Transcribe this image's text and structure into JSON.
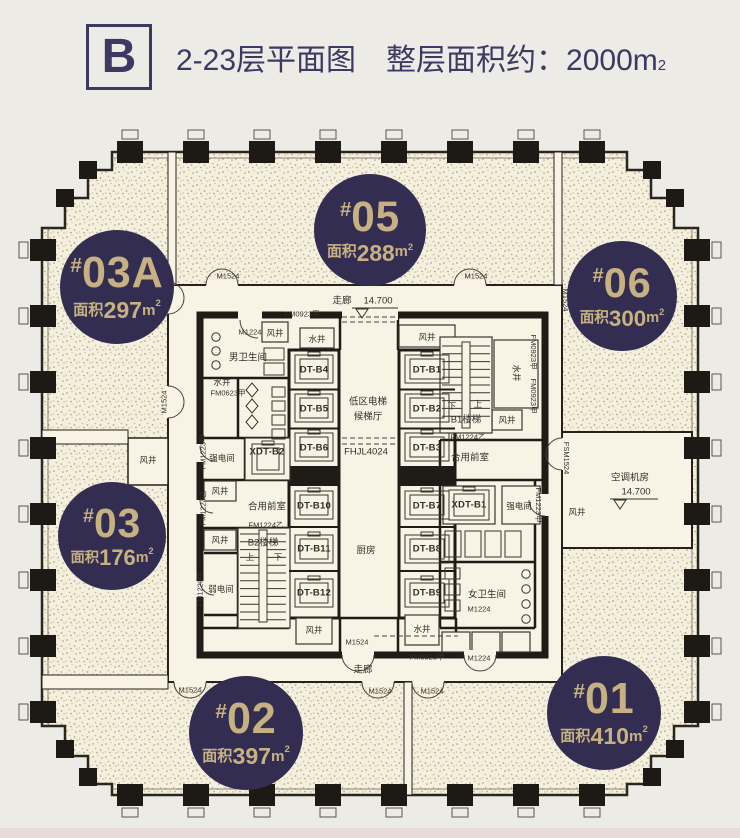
{
  "title": {
    "block_letter": "B",
    "heading_left": "2-23层平面图",
    "area_note": "整层面积约：2000m",
    "area_sup": "2"
  },
  "badge_common": {
    "hash": "#",
    "area_prefix": "面积",
    "unit": "m",
    "sup": "2"
  },
  "badges": [
    {
      "number": "03A",
      "area": "297",
      "cx": 117,
      "cy": 287,
      "r": 57
    },
    {
      "number": "05",
      "area": "288",
      "cx": 370,
      "cy": 230,
      "r": 56
    },
    {
      "number": "06",
      "area": "300",
      "cx": 622,
      "cy": 296,
      "r": 55
    },
    {
      "number": "03",
      "area": "176",
      "cx": 112,
      "cy": 536,
      "r": 54
    },
    {
      "number": "02",
      "area": "397",
      "cx": 246,
      "cy": 733,
      "r": 57
    },
    {
      "number": "01",
      "area": "410",
      "cx": 604,
      "cy": 713,
      "r": 57
    }
  ],
  "colors": {
    "navy": "#3d3963",
    "badge_navy": "#332e51",
    "badge_gold": "#c7b183",
    "wall": "#1f1b16",
    "floor_cream": "#f5efdd",
    "background": "#ecebe6"
  },
  "plan_labels": [
    {
      "t": "走廊",
      "x": 342,
      "y": 301,
      "c": "rm"
    },
    {
      "t": "14.700",
      "x": 378,
      "y": 301,
      "c": "rm"
    },
    {
      "t": "FM0923甲",
      "x": 302,
      "y": 314,
      "c": "code"
    },
    {
      "t": "M1524",
      "x": 228,
      "y": 276,
      "c": "code"
    },
    {
      "t": "M1524",
      "x": 476,
      "y": 276,
      "c": "code"
    },
    {
      "t": "M1524",
      "x": 164,
      "y": 298,
      "c": "code",
      "r": -90
    },
    {
      "t": "M1524",
      "x": 164,
      "y": 402,
      "c": "code",
      "r": -90
    },
    {
      "t": "M1224",
      "x": 250,
      "y": 332,
      "c": "code"
    },
    {
      "t": "风井",
      "x": 275,
      "y": 333,
      "c": "sm"
    },
    {
      "t": "水井",
      "x": 317,
      "y": 339,
      "c": "sm"
    },
    {
      "t": "男卫生间",
      "x": 248,
      "y": 358,
      "c": "rm"
    },
    {
      "t": "水井",
      "x": 222,
      "y": 382,
      "c": "sm"
    },
    {
      "t": "FM0623甲",
      "x": 228,
      "y": 393,
      "c": "code"
    },
    {
      "t": "DT-B4",
      "x": 314,
      "y": 370,
      "c": "dt"
    },
    {
      "t": "DT-B5",
      "x": 314,
      "y": 409,
      "c": "dt"
    },
    {
      "t": "DT-B6",
      "x": 314,
      "y": 448,
      "c": "dt"
    },
    {
      "t": "DT-B10",
      "x": 314,
      "y": 506,
      "c": "dt"
    },
    {
      "t": "DT-B11",
      "x": 314,
      "y": 549,
      "c": "dt"
    },
    {
      "t": "DT-B12",
      "x": 314,
      "y": 593,
      "c": "dt"
    },
    {
      "t": "风井",
      "x": 427,
      "y": 337,
      "c": "sm"
    },
    {
      "t": "DT-B1",
      "x": 427,
      "y": 370,
      "c": "dt"
    },
    {
      "t": "DT-B2",
      "x": 427,
      "y": 409,
      "c": "dt"
    },
    {
      "t": "DT-B3",
      "x": 427,
      "y": 448,
      "c": "dt"
    },
    {
      "t": "DT-B7",
      "x": 427,
      "y": 506,
      "c": "dt"
    },
    {
      "t": "DT-B8",
      "x": 427,
      "y": 549,
      "c": "dt"
    },
    {
      "t": "DT-B9",
      "x": 427,
      "y": 593,
      "c": "dt"
    },
    {
      "t": "低区电梯",
      "x": 368,
      "y": 402,
      "c": "rm"
    },
    {
      "t": "候梯厅",
      "x": 368,
      "y": 417,
      "c": "rm"
    },
    {
      "t": "FHJL4024",
      "x": 366,
      "y": 452,
      "c": "rm"
    },
    {
      "t": "下",
      "x": 452,
      "y": 406,
      "c": "sm"
    },
    {
      "t": "上",
      "x": 478,
      "y": 404,
      "c": "sm"
    },
    {
      "t": "B1楼梯",
      "x": 466,
      "y": 420,
      "c": "rm"
    },
    {
      "t": "FM0923甲",
      "x": 533,
      "y": 352,
      "c": "code",
      "r": 90
    },
    {
      "t": "水井",
      "x": 516,
      "y": 373,
      "c": "sm",
      "r": 90
    },
    {
      "t": "FM0923甲",
      "x": 533,
      "y": 396,
      "c": "code",
      "r": 90
    },
    {
      "t": "风井",
      "x": 507,
      "y": 420,
      "c": "sm"
    },
    {
      "t": "FM1224乙",
      "x": 468,
      "y": 437,
      "c": "code"
    },
    {
      "t": "合用前室",
      "x": 470,
      "y": 458,
      "c": "rm"
    },
    {
      "t": "FM1223甲",
      "x": 538,
      "y": 505,
      "c": "code",
      "r": 90
    },
    {
      "t": "XDT-B1",
      "x": 469,
      "y": 505,
      "c": "dt"
    },
    {
      "t": "强电间",
      "x": 519,
      "y": 506,
      "c": "sm"
    },
    {
      "t": "女卫生间",
      "x": 487,
      "y": 595,
      "c": "rm"
    },
    {
      "t": "M1224",
      "x": 479,
      "y": 609,
      "c": "code"
    },
    {
      "t": "M1224",
      "x": 479,
      "y": 658,
      "c": "code"
    },
    {
      "t": "水井",
      "x": 422,
      "y": 629,
      "c": "sm"
    },
    {
      "t": "FM1223甲",
      "x": 203,
      "y": 452,
      "c": "code",
      "r": -90
    },
    {
      "t": "强电间",
      "x": 222,
      "y": 458,
      "c": "sm"
    },
    {
      "t": "XDT-B2",
      "x": 267,
      "y": 452,
      "c": "dt"
    },
    {
      "t": "风井",
      "x": 220,
      "y": 491,
      "c": "sm"
    },
    {
      "t": "FM1224乙",
      "x": 203,
      "y": 508,
      "c": "code",
      "r": -90
    },
    {
      "t": "合用前室",
      "x": 267,
      "y": 507,
      "c": "rm"
    },
    {
      "t": "FM1224乙",
      "x": 266,
      "y": 525,
      "c": "code"
    },
    {
      "t": "风井",
      "x": 220,
      "y": 540,
      "c": "sm"
    },
    {
      "t": "B2楼梯",
      "x": 263,
      "y": 543,
      "c": "rm"
    },
    {
      "t": "上",
      "x": 250,
      "y": 557,
      "c": "sm"
    },
    {
      "t": "下",
      "x": 278,
      "y": 557,
      "c": "sm"
    },
    {
      "t": "弱电间",
      "x": 221,
      "y": 589,
      "c": "sm"
    },
    {
      "t": "FM1223甲",
      "x": 200,
      "y": 589,
      "c": "code",
      "r": -90
    },
    {
      "t": "厨房",
      "x": 366,
      "y": 551,
      "c": "rm"
    },
    {
      "t": "风井",
      "x": 314,
      "y": 630,
      "c": "sm"
    },
    {
      "t": "M1524",
      "x": 357,
      "y": 642,
      "c": "code"
    },
    {
      "t": "FM0923甲",
      "x": 427,
      "y": 657,
      "c": "code"
    },
    {
      "t": "走廊",
      "x": 363,
      "y": 670,
      "c": "rm"
    },
    {
      "t": "M1524",
      "x": 190,
      "y": 690,
      "c": "code"
    },
    {
      "t": "M1524",
      "x": 380,
      "y": 691,
      "c": "code"
    },
    {
      "t": "M1524",
      "x": 432,
      "y": 691,
      "c": "code"
    },
    {
      "t": "风井",
      "x": 148,
      "y": 460,
      "c": "sm"
    },
    {
      "t": "M1524",
      "x": 565,
      "y": 300,
      "c": "code",
      "r": 90
    },
    {
      "t": "FSM1524",
      "x": 566,
      "y": 458,
      "c": "code",
      "r": 90
    },
    {
      "t": "空调机房",
      "x": 630,
      "y": 478,
      "c": "rm"
    },
    {
      "t": "14.700",
      "x": 636,
      "y": 492,
      "c": "rm"
    },
    {
      "t": "风井",
      "x": 577,
      "y": 512,
      "c": "sm"
    }
  ]
}
